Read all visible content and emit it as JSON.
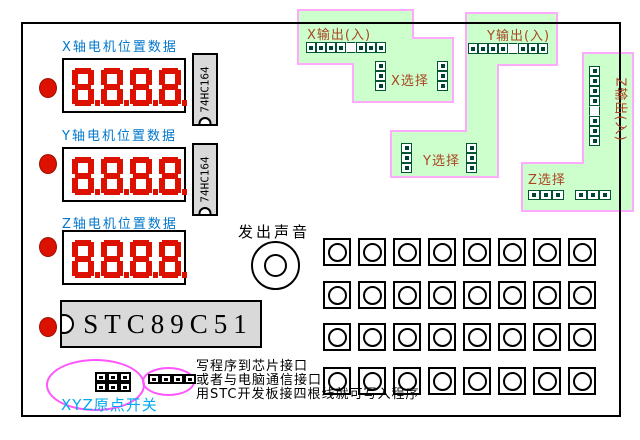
{
  "displays": [
    {
      "label": "X轴电机位置数据",
      "value": "8.8.8.8."
    },
    {
      "label": "Y轴电机位置数据",
      "value": "8.8.8.8."
    },
    {
      "label": "Z轴电机位置数据",
      "value": "8.8.8.8."
    }
  ],
  "chips": {
    "shift_register_label": "74HC164",
    "mcu_label": "STC89C51"
  },
  "speaker": {
    "label": "发出声音"
  },
  "io_regions": {
    "x": {
      "output_label": "X输出(入)",
      "select_label": "X选择",
      "io_pattern": [
        1,
        1,
        1,
        1,
        0,
        1,
        1,
        1
      ],
      "select_pattern": [
        1,
        1,
        1
      ]
    },
    "y": {
      "output_label": "Y输出(入)",
      "select_label": "Y选择",
      "io_pattern": [
        1,
        1,
        1,
        1,
        0,
        1,
        1,
        1
      ],
      "select_pattern": [
        1,
        1,
        1
      ]
    },
    "z": {
      "output_label": "Z输出(入)",
      "select_label": "Z选择",
      "io_pattern": [
        1,
        1,
        1,
        1,
        0,
        1,
        1,
        1
      ],
      "select_pattern": [
        1,
        1,
        1
      ]
    }
  },
  "origin_switch": {
    "label": "XYZ原点开关",
    "block_pattern": [
      1,
      1,
      1,
      1,
      1,
      1
    ],
    "program_header_pattern": [
      1,
      1,
      1,
      1
    ]
  },
  "notes": [
    "写程序到芯片接口",
    "或者与电脑通信接口",
    "用STC开发板接四根线就可写入程序"
  ],
  "button_grid": {
    "rows": 4,
    "cols": 8
  },
  "colors": {
    "display_red": "#dd1100",
    "led_red": "#dd1100",
    "axis_label_blue": "#0077cc",
    "origin_label_cyan": "#00aaee",
    "region_green": "#ccffcc",
    "region_border_pink": "#ffaaff",
    "header_green": "#005533",
    "io_label_brown": "#aa4422",
    "ellipse_magenta": "#ff55ff",
    "chip_gray": "#d9d9d9"
  }
}
